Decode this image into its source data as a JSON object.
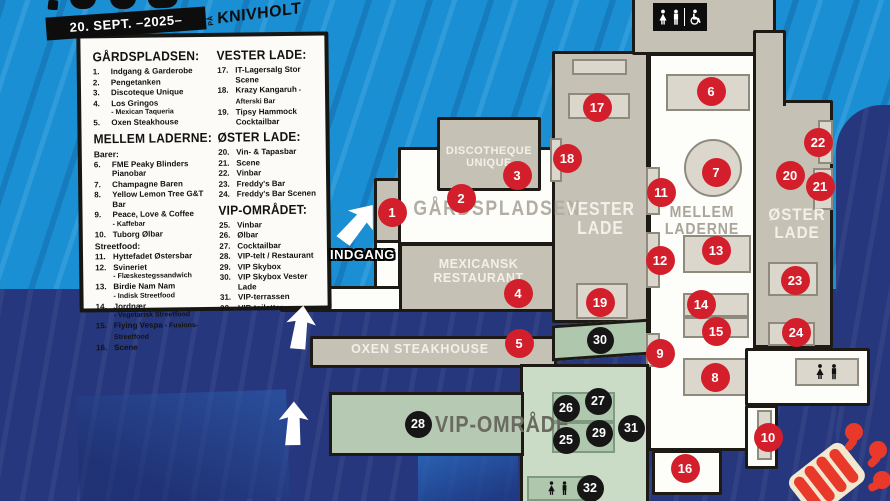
{
  "header": {
    "date": "20. SEPT. –2025–",
    "venue_prefix": "PÅ",
    "venue": "KNIVHOLT"
  },
  "legend": {
    "columns": [
      [
        {
          "title": "GÅRDSPLADSEN:",
          "groups": [
            {
              "label": "",
              "items": [
                {
                  "n": "1.",
                  "text": "Indgang & Garderobe"
                },
                {
                  "n": "2.",
                  "text": "Pengetanken"
                },
                {
                  "n": "3.",
                  "text": "Discoteque Unique"
                },
                {
                  "n": "4.",
                  "text": "Los Gringos",
                  "sub": "- Mexican Taqueria"
                },
                {
                  "n": "5.",
                  "text": "Oxen Steakhouse"
                }
              ]
            }
          ]
        },
        {
          "title": "MELLEM LADERNE:",
          "groups": [
            {
              "label": "Barer:",
              "items": [
                {
                  "n": "6.",
                  "text": "FME Peaky Blinders Pianobar"
                },
                {
                  "n": "7.",
                  "text": "Champagne Baren"
                },
                {
                  "n": "8.",
                  "text": "Yellow Lemon Tree G&T Bar"
                },
                {
                  "n": "9.",
                  "text": "Peace, Love & Coffee",
                  "sub": "- Kaffebar"
                },
                {
                  "n": "10.",
                  "text": "Tuborg Ølbar"
                }
              ]
            },
            {
              "label": "Streetfood:",
              "items": [
                {
                  "n": "11.",
                  "text": "Hyttefadet Østersbar"
                },
                {
                  "n": "12.",
                  "text": "Svineriet",
                  "sub": "- Flæskestegssandwich"
                },
                {
                  "n": "13.",
                  "text": "Birdie Nam Nam",
                  "sub": "- Indisk Streetfood"
                },
                {
                  "n": "14.",
                  "text": "Jordnær",
                  "sub": "- Vegetarisk Streetfood"
                },
                {
                  "n": "15.",
                  "text": "Flying Vespa",
                  "sub_inline": "- Fusions-Streetfood"
                },
                {
                  "n": "16.",
                  "text": "Scene"
                }
              ]
            }
          ]
        }
      ],
      [
        {
          "title": "VESTER LADE:",
          "groups": [
            {
              "label": "",
              "items": [
                {
                  "n": "17.",
                  "text": "IT-Lagersalg Stor Scene"
                },
                {
                  "n": "18.",
                  "text": "Krazy Kangaruh",
                  "sub_inline": "- Afterski Bar"
                },
                {
                  "n": "19.",
                  "text": "Tipsy Hammock Cocktailbar"
                }
              ]
            }
          ]
        },
        {
          "title": "ØSTER LADE:",
          "groups": [
            {
              "label": "",
              "items": [
                {
                  "n": "20.",
                  "text": "Vin- & Tapasbar"
                },
                {
                  "n": "21.",
                  "text": "Scene"
                },
                {
                  "n": "22.",
                  "text": "Vinbar"
                },
                {
                  "n": "23.",
                  "text": "Freddy's Bar"
                },
                {
                  "n": "24.",
                  "text": "Freddy's Bar Scenen"
                }
              ]
            }
          ]
        },
        {
          "title": "VIP-OMRÅDET:",
          "groups": [
            {
              "label": "",
              "items": [
                {
                  "n": "25.",
                  "text": "Vinbar"
                },
                {
                  "n": "26.",
                  "text": "Ølbar"
                },
                {
                  "n": "27.",
                  "text": "Cocktailbar"
                },
                {
                  "n": "28.",
                  "text": "VIP-telt / Restaurant"
                },
                {
                  "n": "29.",
                  "text": "VIP Skybox"
                },
                {
                  "n": "30.",
                  "text": "VIP Skybox Vester Lade"
                },
                {
                  "n": "31.",
                  "text": "VIP-terrassen"
                },
                {
                  "n": "32.",
                  "text": "VIP-toiletter"
                }
              ]
            }
          ]
        }
      ]
    ]
  },
  "map": {
    "labels": {
      "gaardspladsen": "GÅRDSPLADSEN",
      "discoteque_1": "DISCOTHEQUE",
      "discoteque_2": "UNIQUE",
      "mexicansk_1": "MEXICANSK",
      "mexicansk_2": "RESTAURANT",
      "oxen": "OXEN STEAKHOUSE",
      "vester_1": "VESTER",
      "vester_2": "LADE",
      "mellem_1": "MELLEM",
      "mellem_2": "LADERNE",
      "oster_1": "ØSTER",
      "oster_2": "LADE",
      "vip": "VIP-OMRÅDE",
      "indgang": "INDGANG"
    },
    "markers": [
      {
        "n": "1",
        "x": 392,
        "y": 212,
        "variant": "red"
      },
      {
        "n": "2",
        "x": 461,
        "y": 198,
        "variant": "red"
      },
      {
        "n": "3",
        "x": 517,
        "y": 175,
        "variant": "red"
      },
      {
        "n": "4",
        "x": 518,
        "y": 293,
        "variant": "red"
      },
      {
        "n": "5",
        "x": 519,
        "y": 343,
        "variant": "red"
      },
      {
        "n": "6",
        "x": 711,
        "y": 91,
        "variant": "red"
      },
      {
        "n": "7",
        "x": 716,
        "y": 172,
        "variant": "red"
      },
      {
        "n": "8",
        "x": 715,
        "y": 377,
        "variant": "red"
      },
      {
        "n": "9",
        "x": 660,
        "y": 353,
        "variant": "red"
      },
      {
        "n": "10",
        "x": 768,
        "y": 437,
        "variant": "red"
      },
      {
        "n": "11",
        "x": 661,
        "y": 192,
        "variant": "red"
      },
      {
        "n": "12",
        "x": 660,
        "y": 260,
        "variant": "red"
      },
      {
        "n": "13",
        "x": 716,
        "y": 250,
        "variant": "red"
      },
      {
        "n": "14",
        "x": 701,
        "y": 304,
        "variant": "red"
      },
      {
        "n": "15",
        "x": 716,
        "y": 331,
        "variant": "red"
      },
      {
        "n": "16",
        "x": 685,
        "y": 468,
        "variant": "red"
      },
      {
        "n": "17",
        "x": 597,
        "y": 107,
        "variant": "red"
      },
      {
        "n": "18",
        "x": 567,
        "y": 158,
        "variant": "red"
      },
      {
        "n": "19",
        "x": 600,
        "y": 302,
        "variant": "red"
      },
      {
        "n": "20",
        "x": 790,
        "y": 175,
        "variant": "red"
      },
      {
        "n": "21",
        "x": 820,
        "y": 186,
        "variant": "red"
      },
      {
        "n": "22",
        "x": 818,
        "y": 142,
        "variant": "red"
      },
      {
        "n": "23",
        "x": 795,
        "y": 280,
        "variant": "red"
      },
      {
        "n": "24",
        "x": 796,
        "y": 332,
        "variant": "red"
      },
      {
        "n": "25",
        "x": 566,
        "y": 440,
        "variant": "black"
      },
      {
        "n": "26",
        "x": 566,
        "y": 408,
        "variant": "black"
      },
      {
        "n": "27",
        "x": 598,
        "y": 401,
        "variant": "black"
      },
      {
        "n": "28",
        "x": 418,
        "y": 424,
        "variant": "black"
      },
      {
        "n": "29",
        "x": 599,
        "y": 433,
        "variant": "black"
      },
      {
        "n": "30",
        "x": 600,
        "y": 340,
        "variant": "black"
      },
      {
        "n": "31",
        "x": 631,
        "y": 428,
        "variant": "black"
      },
      {
        "n": "32",
        "x": 590,
        "y": 488,
        "variant": "black"
      }
    ]
  },
  "colors": {
    "sky_blue": "#1B8FD3",
    "navy": "#26377E",
    "building_gray": "#C6C1B5",
    "stage_light": "#DBD7CC",
    "vip_green_dark": "#B5C9B3",
    "vip_green_light": "#CBDCC6",
    "marker_red": "#D31F2B",
    "marker_black": "#161616"
  }
}
